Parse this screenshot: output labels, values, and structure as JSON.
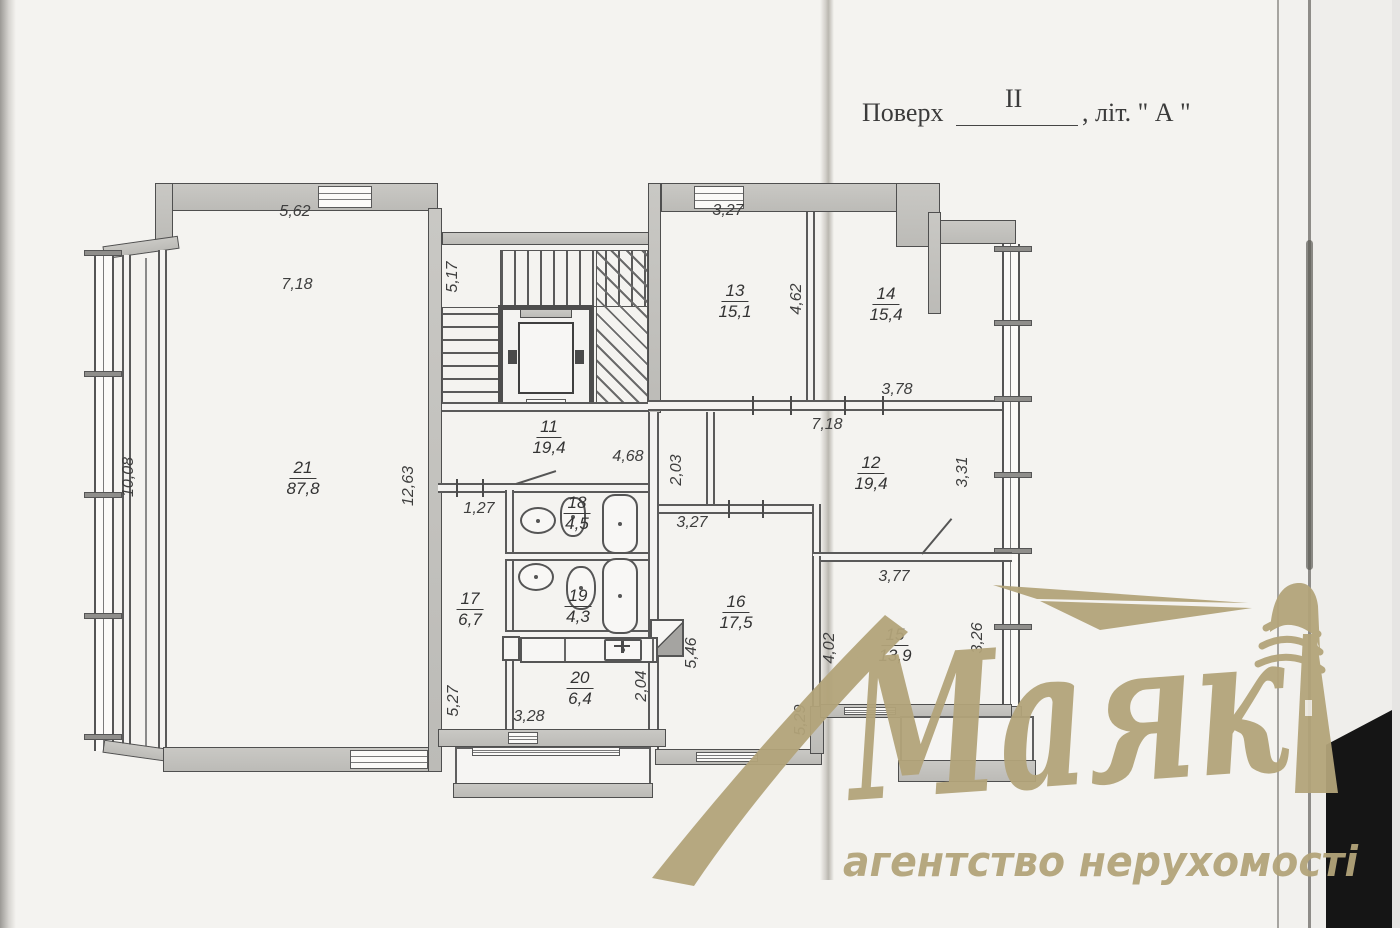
{
  "header": {
    "label": "Поверх",
    "floor": "II",
    "suffix": ", літ. \" А \""
  },
  "watermark": {
    "brand": "Маяк",
    "tagline": "агентство нерухомості",
    "color": "#b3a47a"
  },
  "plan": {
    "rooms": [
      {
        "number": "21",
        "area": "87,8",
        "x": 303,
        "y": 458
      },
      {
        "number": "11",
        "area": "19,4",
        "x": 549,
        "y": 417
      },
      {
        "number": "13",
        "area": "15,1",
        "x": 735,
        "y": 281
      },
      {
        "number": "14",
        "area": "15,4",
        "x": 886,
        "y": 284
      },
      {
        "number": "12",
        "area": "19,4",
        "x": 871,
        "y": 453
      },
      {
        "number": "18",
        "area": "4,5",
        "x": 577,
        "y": 493
      },
      {
        "number": "19",
        "area": "4,3",
        "x": 578,
        "y": 586
      },
      {
        "number": "17",
        "area": "6,7",
        "x": 470,
        "y": 589
      },
      {
        "number": "20",
        "area": "6,4",
        "x": 580,
        "y": 668
      },
      {
        "number": "16",
        "area": "17,5",
        "x": 736,
        "y": 592
      },
      {
        "number": "15",
        "area": "13,9",
        "x": 895,
        "y": 625
      }
    ],
    "dimensions": [
      {
        "text": "5,62",
        "x": 295,
        "y": 212,
        "v": false
      },
      {
        "text": "7,18",
        "x": 297,
        "y": 285,
        "v": false
      },
      {
        "text": "5,17",
        "x": 453,
        "y": 277,
        "v": true
      },
      {
        "text": "3,27",
        "x": 728,
        "y": 211,
        "v": false
      },
      {
        "text": "4,62",
        "x": 797,
        "y": 299,
        "v": true
      },
      {
        "text": "3,78",
        "x": 897,
        "y": 390,
        "v": false
      },
      {
        "text": "10,08",
        "x": 129,
        "y": 477,
        "v": true
      },
      {
        "text": "12,63",
        "x": 409,
        "y": 486,
        "v": true
      },
      {
        "text": "4,68",
        "x": 628,
        "y": 457,
        "v": false
      },
      {
        "text": "1,27",
        "x": 479,
        "y": 509,
        "v": false
      },
      {
        "text": "2,03",
        "x": 677,
        "y": 470,
        "v": true
      },
      {
        "text": "7,18",
        "x": 827,
        "y": 425,
        "v": false
      },
      {
        "text": "3,31",
        "x": 963,
        "y": 472,
        "v": true
      },
      {
        "text": "3,27",
        "x": 692,
        "y": 523,
        "v": false
      },
      {
        "text": "3,77",
        "x": 894,
        "y": 577,
        "v": false
      },
      {
        "text": "4,02",
        "x": 830,
        "y": 648,
        "v": true
      },
      {
        "text": "3,26",
        "x": 978,
        "y": 638,
        "v": true
      },
      {
        "text": "5,46",
        "x": 692,
        "y": 653,
        "v": true
      },
      {
        "text": "5,29",
        "x": 801,
        "y": 720,
        "v": true
      },
      {
        "text": "5,27",
        "x": 454,
        "y": 701,
        "v": true
      },
      {
        "text": "2,04",
        "x": 642,
        "y": 686,
        "v": true
      },
      {
        "text": "3,28",
        "x": 529,
        "y": 717,
        "v": false
      }
    ]
  }
}
